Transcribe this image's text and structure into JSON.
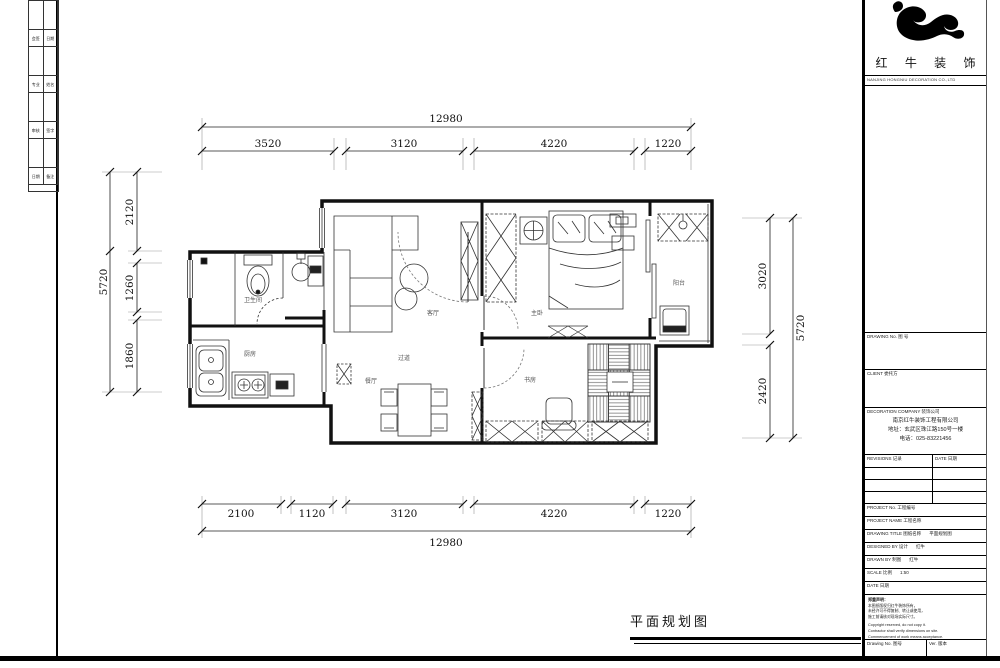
{
  "sheet": {
    "bottom_title": "平面规划图"
  },
  "corner_table": {
    "rows": [
      [
        "会签",
        "日期"
      ],
      [
        "专业",
        "姓名"
      ],
      [
        "审核",
        "签字"
      ],
      [
        "日期",
        "备注"
      ]
    ]
  },
  "logo": {
    "name": "红 牛 装 饰",
    "subtitle": "NANJING HONGNIU DECORATION CO.,LTD"
  },
  "title_block": {
    "drawing_no_label": "DRAWING No. 图 号",
    "client_label": "CLIENT 委托方",
    "company_label": "DECORATION COMPANY 装饰公司",
    "company_lines": [
      "南京红牛装饰工程有限公司",
      "地址：玄武区珠江路150号一楼",
      "电话：025-83221456"
    ],
    "rev_label": "REVISIONS 记录",
    "rev_date_label": "DATE 日期",
    "rows": [
      {
        "label": "PROJECT No. 工程编号",
        "value": ""
      },
      {
        "label": "PROJECT NAME 工程名称",
        "value": ""
      },
      {
        "label": "DRAWING TITLE 图纸名称",
        "value": "平面规划图"
      },
      {
        "label": "DESIGNED BY 设计",
        "value": "红牛"
      },
      {
        "label": "DRAWN BY 制图",
        "value": "红牛"
      },
      {
        "label": "SCALE 比例",
        "value": "1:50"
      },
      {
        "label": "DATE 日期",
        "value": ""
      }
    ],
    "notes_title": "郑重声明：",
    "notes_zh": [
      "本图纸版权归红牛装饰所有，",
      "未经许可不得复制、转让或使用，",
      "施工前请核对现场实际尺寸。"
    ],
    "notes_en": [
      "Copyright reserved, do not copy it.",
      "Contractor shall verify dimensions on site.",
      "Commencement of work means acceptance."
    ],
    "footer_left": "Drawing No. 图号",
    "footer_right": "Ver. 版本"
  },
  "plan": {
    "rooms": [
      {
        "name": "卫生间"
      },
      {
        "name": "厨房"
      },
      {
        "name": "客厅"
      },
      {
        "name": "餐厅"
      },
      {
        "name": "过道"
      },
      {
        "name": "主卧"
      },
      {
        "name": "书房"
      },
      {
        "name": "阳台"
      }
    ],
    "dims": {
      "top": {
        "overall": "12980",
        "segments": [
          "3520",
          "3120",
          "4220",
          "1220"
        ]
      },
      "bottom": {
        "overall": "12980",
        "segments": [
          "2100",
          "1120",
          "3120",
          "4220",
          "1220"
        ]
      },
      "left": {
        "overall": "5720",
        "segments": [
          "2120",
          "1260",
          "1860"
        ]
      },
      "right": {
        "overall": "5720",
        "segments": [
          "3020",
          "2420"
        ]
      }
    }
  }
}
